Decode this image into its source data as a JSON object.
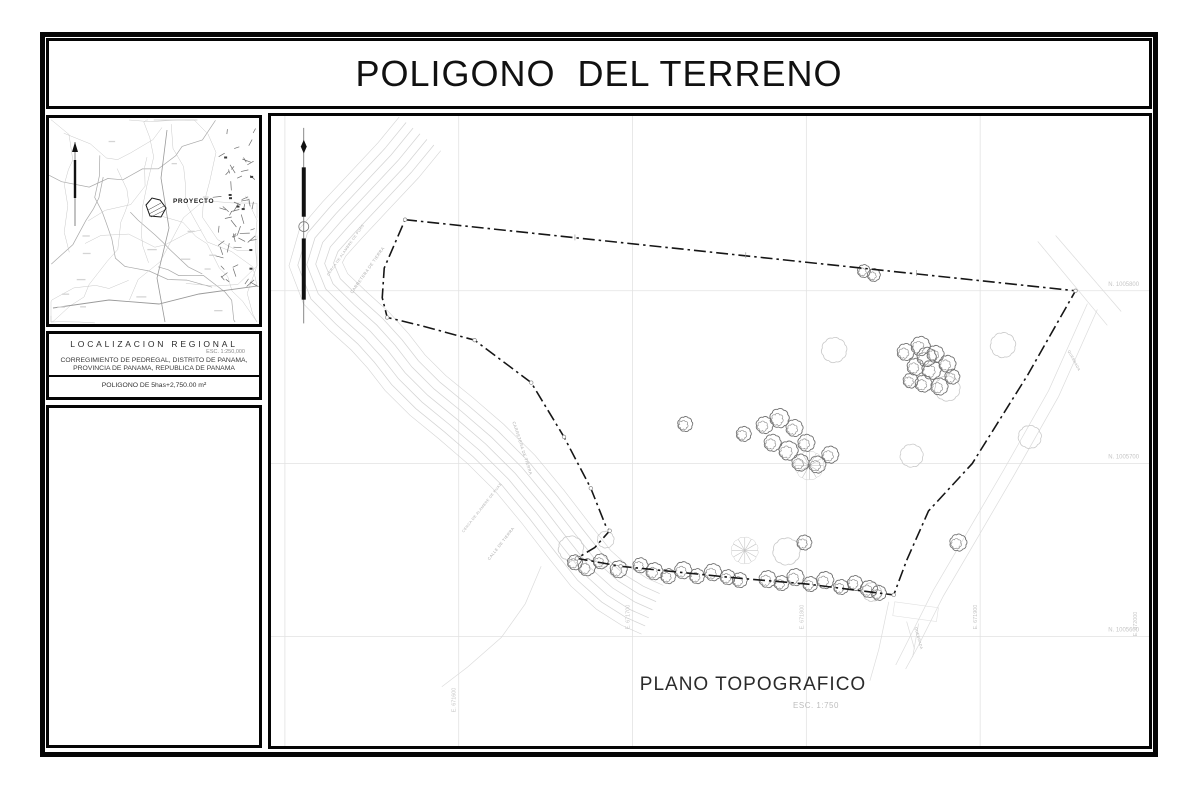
{
  "title": "POLIGONO  DEL TERRENO",
  "palette": {
    "ink": "#0a0a0a",
    "grid": "#e2e2e2",
    "grid_label": "#c6c6c6",
    "road": "#cfcfcf",
    "creek": "#dcdcdc",
    "tree_dark": "#6f6f6f",
    "tree_light": "#c9c9c9",
    "boundary": "#161616"
  },
  "sidebar": {
    "map": {
      "proyecto_label": "PROYECTO"
    },
    "localizacion": {
      "heading": "LOCALIZACION REGIONAL",
      "scale": "ESC. 1:250,000",
      "line1": "CORREGIMIENTO DE PEDREGAL, DISTRITO DE PANAMA,",
      "line2": "PROVINCIA DE PANAMA, REPUBLICA DE PANAMA",
      "area": "POLIGONO DE 5has+2,750.00 m²"
    }
  },
  "plan": {
    "caption": "PLANO TOPOGRAFICO",
    "caption_scale": "ESC. 1:750",
    "north_labels": [
      {
        "text": "N. 1005800",
        "x": 874,
        "y": 172
      },
      {
        "text": "N. 1005700",
        "x": 874,
        "y": 347
      },
      {
        "text": "N. 1005600",
        "x": 874,
        "y": 522
      }
    ],
    "east_labels": [
      {
        "text": "E. 671600",
        "x": 186,
        "y": 604
      },
      {
        "text": "E. 671700",
        "x": 361,
        "y": 520
      },
      {
        "text": "E. 671800",
        "x": 536,
        "y": 520
      },
      {
        "text": "E. 671900",
        "x": 711,
        "y": 520
      },
      {
        "text": "E. 672000",
        "x": 872,
        "y": 527
      }
    ],
    "road_labels": [
      {
        "text": "CERCA DE ALAMBRE DE PUAS",
        "x": 58,
        "y": 162,
        "rot": -55,
        "size": 3.6
      },
      {
        "text": "CARRETERA DE TIERRA",
        "x": 82,
        "y": 180,
        "rot": -55,
        "size": 4.2
      },
      {
        "text": "CARRETERA DE TIERRA",
        "x": 243,
        "y": 310,
        "rot": 72,
        "size": 4.2
      },
      {
        "text": "CERCA DE ALAMBRE DE PUAS",
        "x": 194,
        "y": 422,
        "rot": -52,
        "size": 3.6
      },
      {
        "text": "CALLE DE TIERRA",
        "x": 220,
        "y": 450,
        "rot": -52,
        "size": 4.0
      },
      {
        "text": "QUEBRADA",
        "x": 648,
        "y": 518,
        "rot": 75,
        "size": 3.6
      },
      {
        "text": "QUEBRADA",
        "x": 802,
        "y": 238,
        "rot": 62,
        "size": 3.6
      }
    ],
    "geometry": {
      "grid_v": [
        14,
        189,
        364,
        539,
        714
      ],
      "grid_h": [
        177,
        352,
        527
      ],
      "boundary": [
        [
          135,
          105
        ],
        [
          810,
          177
        ],
        [
          762,
          262
        ],
        [
          706,
          352
        ],
        [
          662,
          400
        ],
        [
          640,
          450
        ],
        [
          627,
          485
        ],
        [
          540,
          474
        ],
        [
          470,
          468
        ],
        [
          352,
          456
        ],
        [
          308,
          448
        ],
        [
          326,
          437
        ],
        [
          341,
          420
        ],
        [
          337,
          415
        ],
        [
          322,
          377
        ],
        [
          295,
          325
        ],
        [
          262,
          270
        ],
        [
          205,
          227
        ],
        [
          150,
          212
        ],
        [
          117,
          204
        ],
        [
          112,
          184
        ],
        [
          114,
          154
        ],
        [
          135,
          105
        ]
      ],
      "road_center": [
        [
          150,
          18
        ],
        [
          128,
          45
        ],
        [
          100,
          75
        ],
        [
          72,
          105
        ],
        [
          52,
          128
        ],
        [
          45,
          150
        ],
        [
          55,
          175
        ],
        [
          78,
          198
        ],
        [
          100,
          218
        ],
        [
          118,
          238
        ],
        [
          135,
          260
        ],
        [
          158,
          283
        ],
        [
          186,
          306
        ],
        [
          216,
          332
        ],
        [
          246,
          362
        ],
        [
          274,
          396
        ],
        [
          300,
          430
        ],
        [
          322,
          458
        ],
        [
          344,
          478
        ],
        [
          366,
          492
        ],
        [
          384,
          500
        ]
      ],
      "road_offsets": [
        -27,
        -18,
        -9,
        0,
        9,
        18,
        27
      ],
      "trees_dark": [
        [
          306,
          452,
          7
        ],
        [
          318,
          457,
          8
        ],
        [
          332,
          451,
          7
        ],
        [
          350,
          459,
          8
        ],
        [
          372,
          455,
          7
        ],
        [
          386,
          461,
          8
        ],
        [
          400,
          466,
          7
        ],
        [
          415,
          460,
          8
        ],
        [
          429,
          466,
          7
        ],
        [
          445,
          462,
          8
        ],
        [
          460,
          467,
          7
        ],
        [
          472,
          470,
          7
        ],
        [
          500,
          469,
          8
        ],
        [
          514,
          473,
          7
        ],
        [
          528,
          467,
          8
        ],
        [
          543,
          474,
          7
        ],
        [
          558,
          470,
          8
        ],
        [
          574,
          477,
          7
        ],
        [
          588,
          473,
          7
        ],
        [
          602,
          479,
          8
        ],
        [
          612,
          483,
          7
        ],
        [
          497,
          313,
          8
        ],
        [
          512,
          306,
          9
        ],
        [
          527,
          316,
          8
        ],
        [
          505,
          331,
          8
        ],
        [
          521,
          339,
          9
        ],
        [
          539,
          331,
          8
        ],
        [
          533,
          351,
          8
        ],
        [
          550,
          353,
          8
        ],
        [
          563,
          343,
          8
        ],
        [
          476,
          322,
          7
        ],
        [
          417,
          312,
          7
        ],
        [
          639,
          239,
          8
        ],
        [
          654,
          233,
          9
        ],
        [
          669,
          241,
          8
        ],
        [
          649,
          254,
          8
        ],
        [
          665,
          257,
          9
        ],
        [
          681,
          251,
          8
        ],
        [
          657,
          271,
          8
        ],
        [
          673,
          274,
          8
        ],
        [
          644,
          268,
          7
        ],
        [
          686,
          264,
          7
        ],
        [
          660,
          244,
          9
        ],
        [
          597,
          157,
          6
        ],
        [
          607,
          161,
          6
        ],
        [
          692,
          432,
          8
        ],
        [
          537,
          432,
          7
        ]
      ],
      "trees_light": [
        [
          567,
          237,
          12
        ],
        [
          737,
          232,
          12
        ],
        [
          681,
          276,
          12
        ],
        [
          764,
          325,
          11
        ],
        [
          645,
          344,
          11
        ],
        [
          519,
          441,
          13
        ],
        [
          302,
          438,
          12
        ],
        [
          337,
          429,
          8
        ],
        [
          605,
          482,
          9
        ]
      ],
      "palms": [
        [
          542,
          354,
          14
        ],
        [
          477,
          440,
          13
        ]
      ],
      "creeks": [
        [
          [
            822,
            190
          ],
          [
            783,
            278
          ],
          [
            738,
            358
          ],
          [
            702,
            420
          ],
          [
            667,
            480
          ],
          [
            642,
            530
          ],
          [
            629,
            556
          ]
        ],
        [
          [
            832,
            196
          ],
          [
            793,
            284
          ],
          [
            748,
            364
          ],
          [
            712,
            426
          ],
          [
            677,
            486
          ],
          [
            652,
            536
          ],
          [
            639,
            560
          ]
        ],
        [
          [
            622,
            492
          ],
          [
            612,
            540
          ],
          [
            603,
            572
          ]
        ],
        [
          [
            272,
            456
          ],
          [
            256,
            494
          ],
          [
            232,
            528
          ],
          [
            198,
            558
          ],
          [
            172,
            578
          ]
        ],
        [
          [
            772,
            127
          ],
          [
            842,
            212
          ]
        ],
        [
          [
            790,
            121
          ],
          [
            856,
            198
          ]
        ],
        [
          [
            640,
            512
          ],
          [
            648,
            540
          ]
        ],
        [
          [
            652,
            514
          ],
          [
            646,
            548
          ]
        ]
      ],
      "corner_box": [
        [
          628,
          492
        ],
        [
          672,
          498
        ],
        [
          670,
          512
        ],
        [
          626,
          506
        ]
      ],
      "vertex_points": [
        [
          135,
          105
        ],
        [
          117,
          204
        ],
        [
          205,
          227
        ],
        [
          262,
          270
        ],
        [
          295,
          325
        ],
        [
          322,
          377
        ],
        [
          341,
          420
        ],
        [
          308,
          448
        ],
        [
          627,
          485
        ],
        [
          810,
          177
        ],
        [
          352,
          456
        ]
      ],
      "edge_ticks": [
        [
          306,
          123
        ],
        [
          478,
          141
        ],
        [
          650,
          159
        ]
      ]
    }
  }
}
